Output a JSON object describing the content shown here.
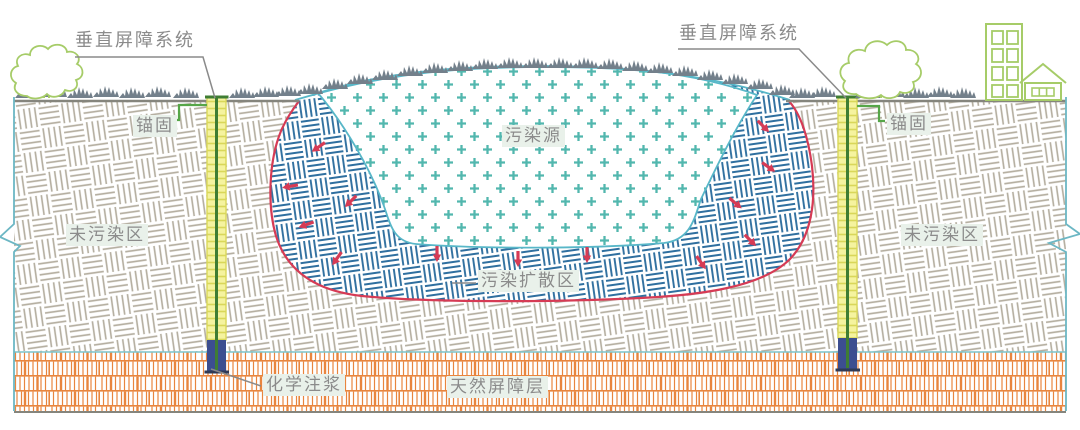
{
  "figure": {
    "type": "engineering-cross-section-diagram",
    "labels": {
      "vertical_barrier_left": "垂直屏障系统",
      "vertical_barrier_right": "垂直屏障系统",
      "anchor_left": "锚固",
      "anchor_right": "锚固",
      "uncontaminated_left": "未污染区",
      "uncontaminated_right": "未污染区",
      "pollution_source": "污染源",
      "pollution_spread_zone": "污染扩散区",
      "chemical_grouting": "化学注浆",
      "natural_barrier_layer": "天然屏障层"
    },
    "colors": {
      "soil_hatch": "#b6b0a2",
      "spread_hatch": "#2f6f9f",
      "source_fill": "#52b7ae",
      "source_outline": "#58b7c8",
      "spread_outline": "#d63b55",
      "arrow": "#d63b55",
      "natural_barrier": "#e8853e",
      "barrier_wall_fill": "#f5f39f",
      "barrier_wall_rung": "#d9d75a",
      "barrier_wall_core": "#3f7d33",
      "grout": "#3c4e90",
      "anchor_line": "#56a648",
      "grass": "#73808b",
      "vegetation": "#a6cc68",
      "ground_line": "#85857d",
      "break_line": "#6cb7c4",
      "label_text": "#8b8b8b",
      "label_bg": "#e9f1ea",
      "leader": "#8a8a8a"
    }
  }
}
